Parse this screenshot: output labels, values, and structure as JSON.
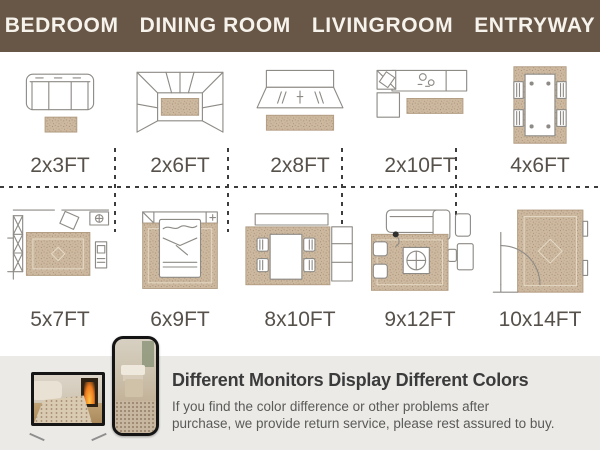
{
  "header": {
    "items": [
      "BEDROOM",
      "DINING ROOM",
      "LIVINGROOM",
      "ENTRYWAY"
    ]
  },
  "size_grid": {
    "top_row": [
      {
        "label": "2x3FT",
        "scene": "sofa-with-runner-diagram"
      },
      {
        "label": "2x6FT",
        "scene": "closet-perspective-runner-diagram"
      },
      {
        "label": "2x8FT",
        "scene": "kitchen-island-runner-diagram"
      },
      {
        "label": "2x10FT",
        "scene": "l-shaped-kitchen-runner-diagram"
      },
      {
        "label": "4x6FT",
        "scene": "dining-table-rug-diagram"
      }
    ],
    "bottom_row": [
      {
        "label": "5x7FT",
        "scene": "bedroom-floorplan-rug-diagram"
      },
      {
        "label": "6x9FT",
        "scene": "bed-on-rug-diagram"
      },
      {
        "label": "8x10FT",
        "scene": "dining-set-on-rug-diagram"
      },
      {
        "label": "9x12FT",
        "scene": "living-room-rug-diagram"
      },
      {
        "label": "10x14FT",
        "scene": "entryway-large-rug-diagram"
      }
    ]
  },
  "notice": {
    "headline": "Different Monitors Display Different Colors",
    "body_line1": "If you find the color difference or other problems after",
    "body_line2": "purchase, we provide return service, please rest assured to buy."
  },
  "colors": {
    "header_bg": "#685747",
    "rug_tan": "#cdb9a0",
    "label_text": "#57514b",
    "dash": "#3d3d3d",
    "panel_bg": "#ebeae7",
    "headline_text": "#3b3b3b"
  }
}
